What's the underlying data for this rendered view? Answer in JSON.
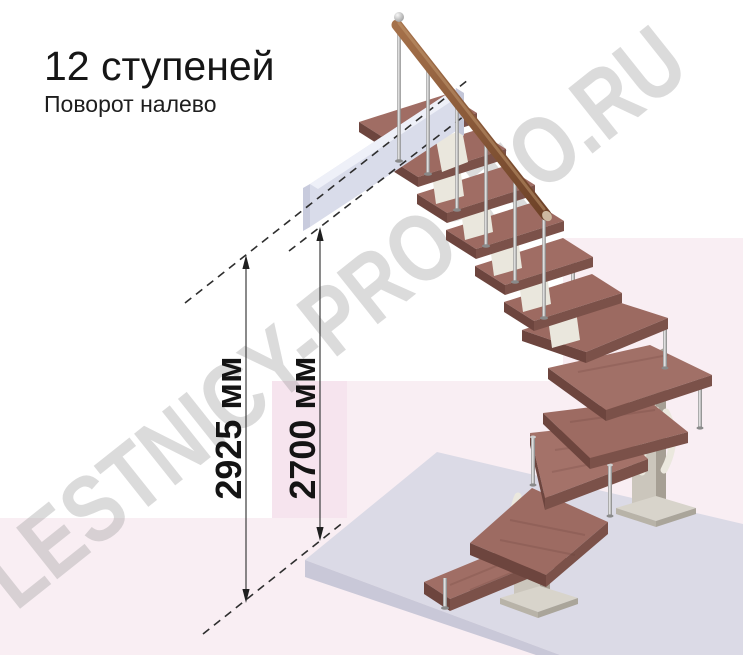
{
  "title": {
    "heading": "12 ступеней",
    "subheading": "Поворот налево"
  },
  "dimensions": {
    "overall_height": "2925 мм",
    "floor_to_floor": "2700 мм"
  },
  "watermark": {
    "text": "LESTNICY-PROSTO.RU"
  },
  "staircase": {
    "steps_total": 12,
    "turn_direction": "налево",
    "straight_treads_upper": 6,
    "winder_treads": 4,
    "straight_treads_lower": 2,
    "has_handrail": true,
    "has_landing_platform": true
  },
  "colors": {
    "tread_wood": "#9d6a61",
    "tread_front_edge": "#7b5149",
    "tread_side_edge": "#6d453e",
    "handrail_wood": "#8c5e3d",
    "metal_column": "#cbc6bc",
    "baluster_metal": "#b5b5b5",
    "landing_platform": "#d9dcea",
    "floor_slab": "#dbdae6",
    "background_pink": "#f9eef3",
    "dimension_band_pink": "#f6e4ee",
    "dimension_line": "#3d3d3d",
    "text": "#141414",
    "watermark_gray": "#8c8c8c"
  }
}
